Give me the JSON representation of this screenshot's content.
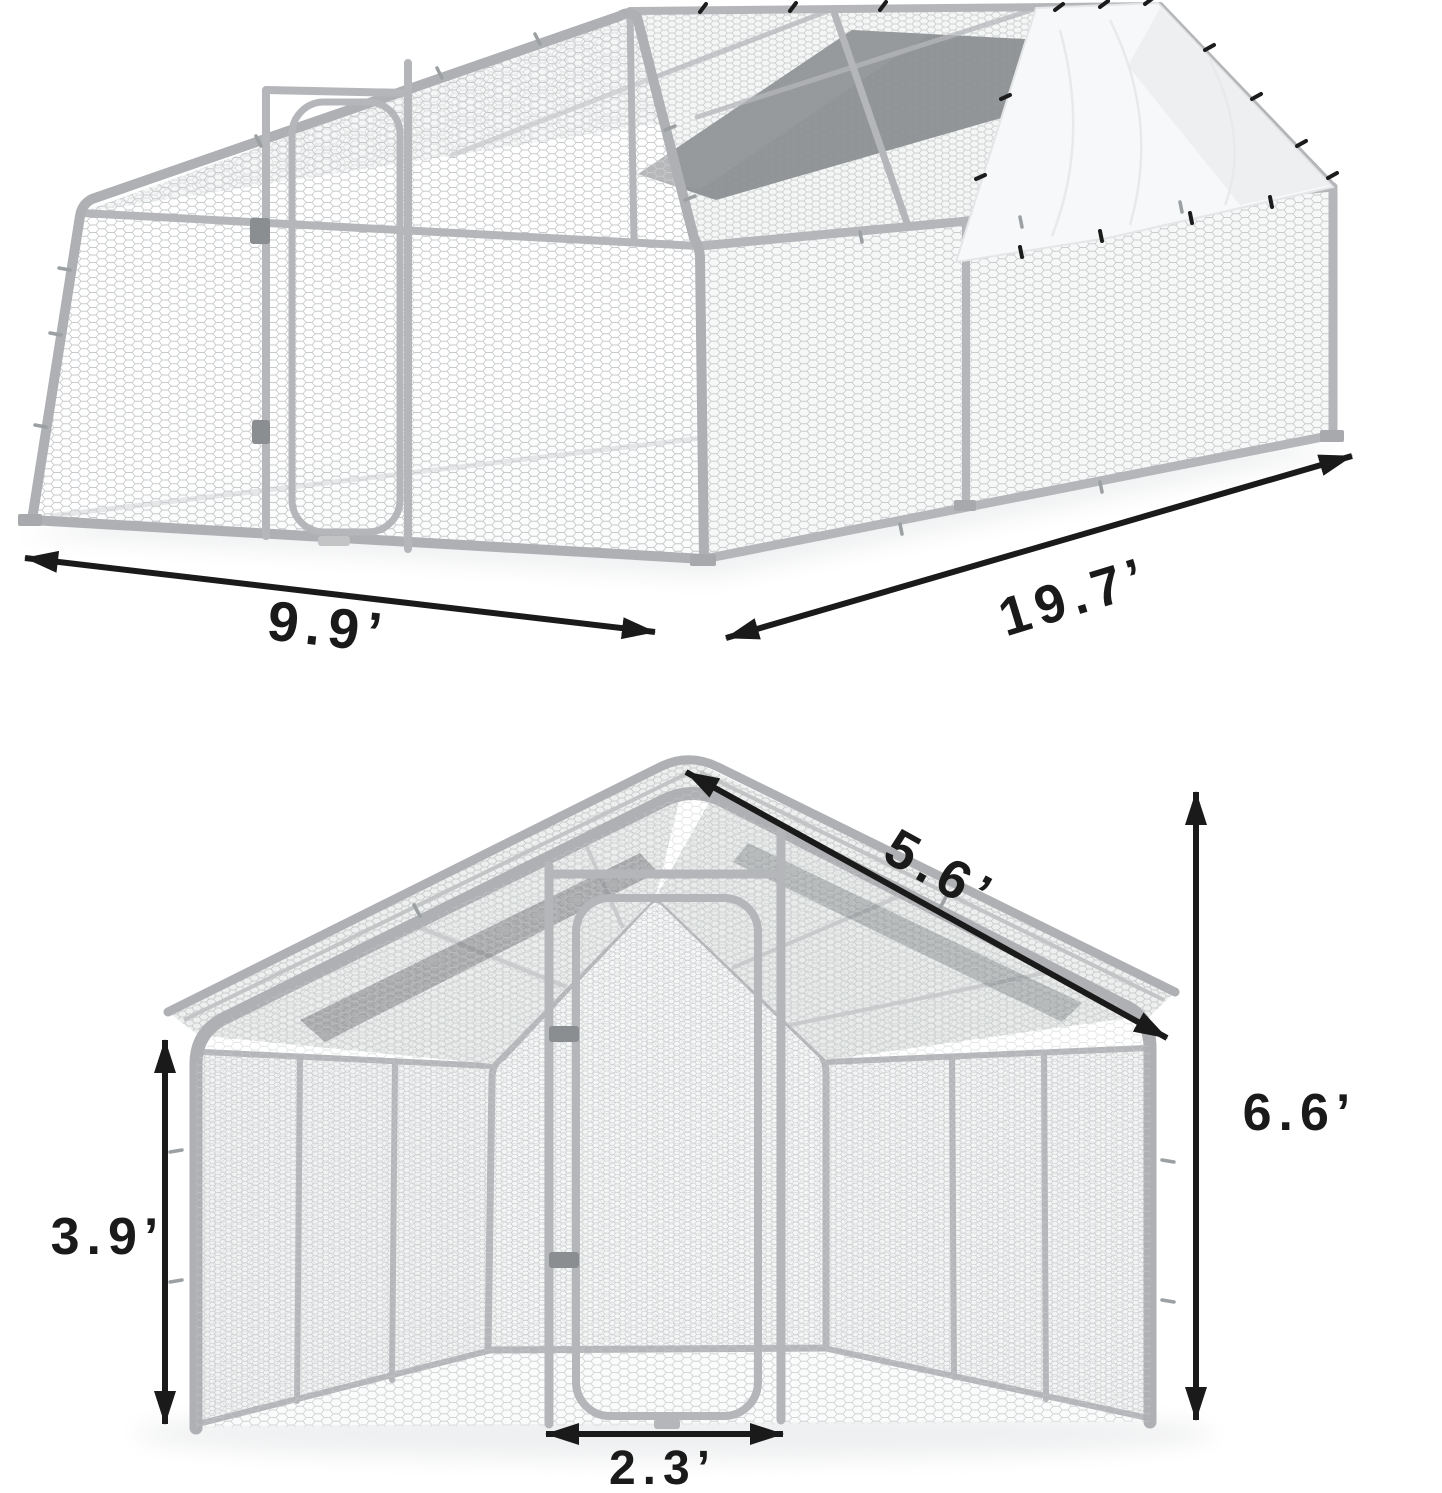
{
  "diagram": {
    "background": "#ffffff",
    "colors": {
      "arrow": "#1a1a1a",
      "frame_tube": "#b4b6b9",
      "mesh_line": "#c9ccce",
      "tarp": "#f7f8f9",
      "shade_cloth": "#8b8e90"
    },
    "iso_view": {
      "width_label": "9.9’",
      "length_label": "19.7’"
    },
    "front_view": {
      "roof_slope_label": "5.6’",
      "total_height_label": "6.6’",
      "wall_height_label": "3.9’",
      "door_width_label": "2.3’"
    }
  }
}
